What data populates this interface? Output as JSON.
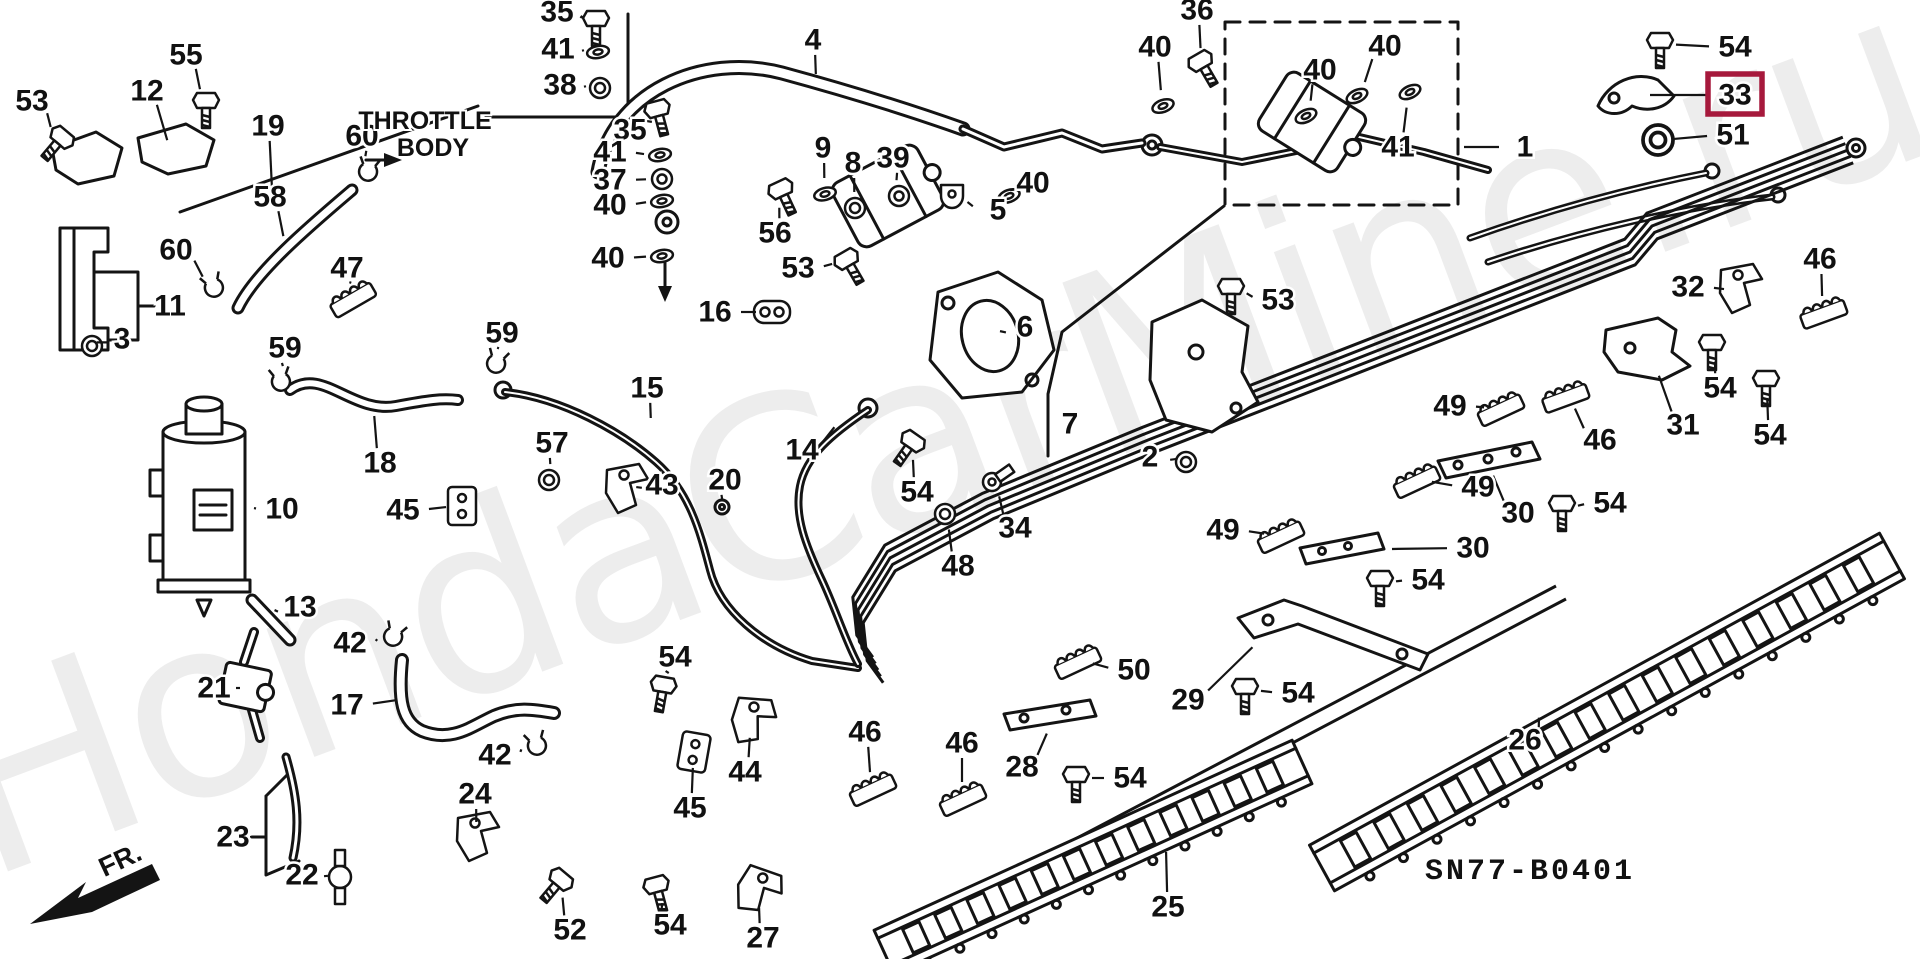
{
  "diagram": {
    "code": "SN77-B0401",
    "watermark": "HondaCarMine.ru",
    "throttle_label_line1": "THROTTLE",
    "throttle_label_line2": "BODY",
    "fr_label": "FR.",
    "ink_color": "#141414",
    "highlight": {
      "part": "33",
      "color": "#A6193C"
    },
    "labels": [
      {
        "n": "53",
        "x": 32,
        "y": 101,
        "px": 60,
        "py": 140,
        "i": "bolt",
        "r": 40
      },
      {
        "n": "12",
        "x": 147,
        "y": 91,
        "px": 168,
        "py": 142,
        "i": "none",
        "r": 0
      },
      {
        "n": "55",
        "x": 186,
        "y": 55,
        "px": 206,
        "py": 104,
        "i": "bolt",
        "r": 0
      },
      {
        "n": "19",
        "x": 268,
        "y": 126,
        "px": 272,
        "py": 188,
        "i": "none",
        "r": 0
      },
      {
        "n": "60",
        "x": 362,
        "y": 136,
        "px": 368,
        "py": 172,
        "i": "clip",
        "r": 10
      },
      {
        "n": "58",
        "x": 270,
        "y": 197,
        "px": 284,
        "py": 238,
        "i": "none",
        "r": 0
      },
      {
        "n": "60",
        "x": 176,
        "y": 250,
        "px": 214,
        "py": 288,
        "i": "clip",
        "r": -20
      },
      {
        "n": "47",
        "x": 347,
        "y": 268,
        "px": 352,
        "py": 298,
        "i": "comb",
        "r": -30
      },
      {
        "n": "11",
        "x": 170,
        "y": 306,
        "px": 154,
        "py": 306,
        "i": "none",
        "r": 0
      },
      {
        "n": "3",
        "x": 122,
        "y": 339,
        "px": 92,
        "py": 346,
        "i": "grommet",
        "r": 0
      },
      {
        "n": "35",
        "x": 557,
        "y": 12,
        "px": 596,
        "py": 22,
        "i": "bolt",
        "r": 0
      },
      {
        "n": "41",
        "x": 558,
        "y": 49,
        "px": 598,
        "py": 52,
        "i": "washer",
        "r": -10
      },
      {
        "n": "38",
        "x": 560,
        "y": 85,
        "px": 600,
        "py": 88,
        "i": "grommet",
        "r": 0
      },
      {
        "n": "35",
        "x": 630,
        "y": 130,
        "px": 658,
        "py": 112,
        "i": "bolt",
        "r": -15
      },
      {
        "n": "41",
        "x": 610,
        "y": 152,
        "px": 660,
        "py": 155,
        "i": "washer",
        "r": -10
      },
      {
        "n": "37",
        "x": 610,
        "y": 180,
        "px": 662,
        "py": 179,
        "i": "nut",
        "r": 0
      },
      {
        "n": "40",
        "x": 610,
        "y": 205,
        "px": 662,
        "py": 201,
        "i": "washer",
        "r": -10
      },
      {
        "n": "40",
        "x": 608,
        "y": 258,
        "px": 662,
        "py": 256,
        "i": "washer",
        "r": -10
      },
      {
        "n": "4",
        "x": 813,
        "y": 40,
        "px": 816,
        "py": 76,
        "i": "none",
        "r": 0
      },
      {
        "n": "9",
        "x": 823,
        "y": 148,
        "px": 825,
        "py": 194,
        "i": "washer",
        "r": -15
      },
      {
        "n": "8",
        "x": 853,
        "y": 163,
        "px": 855,
        "py": 208,
        "i": "grommet",
        "r": 0
      },
      {
        "n": "39",
        "x": 893,
        "y": 158,
        "px": 899,
        "py": 196,
        "i": "nut",
        "r": 0
      },
      {
        "n": "56",
        "x": 775,
        "y": 233,
        "px": 782,
        "py": 192,
        "i": "bolt",
        "r": -25
      },
      {
        "n": "53",
        "x": 798,
        "y": 268,
        "px": 848,
        "py": 262,
        "i": "bolt",
        "r": -30
      },
      {
        "n": "16",
        "x": 715,
        "y": 312,
        "px": 772,
        "py": 312,
        "i": "dgrommet",
        "r": 0
      },
      {
        "n": "5",
        "x": 998,
        "y": 210,
        "px": 952,
        "py": 198,
        "i": "clamp",
        "r": 0
      },
      {
        "n": "40",
        "x": 1033,
        "y": 183,
        "px": 1009,
        "py": 196,
        "i": "washer",
        "r": -20
      },
      {
        "n": "6",
        "x": 1025,
        "y": 327,
        "px": 1004,
        "py": 333,
        "i": "none",
        "r": 0
      },
      {
        "n": "7",
        "x": 1070,
        "y": 424,
        "px": 1052,
        "py": 424,
        "i": "none",
        "r": 0
      },
      {
        "n": "2",
        "x": 1150,
        "y": 457,
        "px": 1186,
        "py": 462,
        "i": "grommet",
        "r": 0
      },
      {
        "n": "36",
        "x": 1197,
        "y": 10,
        "px": 1202,
        "py": 64,
        "i": "bolt",
        "r": -30
      },
      {
        "n": "40",
        "x": 1155,
        "y": 47,
        "px": 1163,
        "py": 106,
        "i": "washer",
        "r": -20
      },
      {
        "n": "40",
        "x": 1320,
        "y": 70,
        "px": 1306,
        "py": 116,
        "i": "washer",
        "r": -25
      },
      {
        "n": "40",
        "x": 1385,
        "y": 46,
        "px": 1357,
        "py": 96,
        "i": "washer",
        "r": -25
      },
      {
        "n": "41",
        "x": 1398,
        "y": 147,
        "px": 1410,
        "py": 92,
        "i": "washer",
        "r": -25
      },
      {
        "n": "1",
        "x": 1525,
        "y": 147,
        "px": 1462,
        "py": 147,
        "i": "none",
        "r": 0
      },
      {
        "n": "54",
        "x": 1735,
        "y": 47,
        "px": 1660,
        "py": 44,
        "i": "bolt",
        "r": 0
      },
      {
        "n": "33",
        "x": 1735,
        "y": 95,
        "px": 1648,
        "py": 95,
        "i": "none",
        "r": 0
      },
      {
        "n": "51",
        "x": 1733,
        "y": 135,
        "px": 1658,
        "py": 140,
        "i": "grommet",
        "r": 0,
        "s": 1.5
      },
      {
        "n": "46",
        "x": 1820,
        "y": 259,
        "px": 1823,
        "py": 312,
        "i": "comb",
        "r": -20
      },
      {
        "n": "32",
        "x": 1688,
        "y": 287,
        "px": 1740,
        "py": 290,
        "i": "bracket",
        "r": 0
      },
      {
        "n": "54",
        "x": 1720,
        "y": 388,
        "px": 1712,
        "py": 346,
        "i": "bolt",
        "r": 0
      },
      {
        "n": "31",
        "x": 1683,
        "y": 425,
        "px": 1658,
        "py": 374,
        "i": "none",
        "r": 0
      },
      {
        "n": "54",
        "x": 1770,
        "y": 435,
        "px": 1766,
        "py": 382,
        "i": "bolt",
        "r": 0
      },
      {
        "n": "46",
        "x": 1600,
        "y": 440,
        "px": 1565,
        "py": 396,
        "i": "comb",
        "r": -20
      },
      {
        "n": "49",
        "x": 1450,
        "y": 406,
        "px": 1500,
        "py": 408,
        "i": "comb",
        "r": -25
      },
      {
        "n": "49",
        "x": 1478,
        "y": 487,
        "px": 1416,
        "py": 480,
        "i": "comb",
        "r": -25
      },
      {
        "n": "30",
        "x": 1518,
        "y": 513,
        "px": 1492,
        "py": 474,
        "i": "none",
        "r": 0
      },
      {
        "n": "54",
        "x": 1610,
        "y": 503,
        "px": 1562,
        "py": 507,
        "i": "bolt",
        "r": 0
      },
      {
        "n": "30",
        "x": 1473,
        "y": 548,
        "px": 1390,
        "py": 549,
        "i": "none",
        "r": 0
      },
      {
        "n": "53",
        "x": 1278,
        "y": 300,
        "px": 1231,
        "py": 290,
        "i": "bolt",
        "r": 0
      },
      {
        "n": "49",
        "x": 1223,
        "y": 530,
        "px": 1280,
        "py": 535,
        "i": "comb",
        "r": -25
      },
      {
        "n": "54",
        "x": 1428,
        "y": 580,
        "px": 1380,
        "py": 582,
        "i": "bolt",
        "r": 0
      },
      {
        "n": "50",
        "x": 1134,
        "y": 670,
        "px": 1077,
        "py": 661,
        "i": "comb",
        "r": -25
      },
      {
        "n": "29",
        "x": 1188,
        "y": 700,
        "px": 1254,
        "py": 646,
        "i": "none",
        "r": 0
      },
      {
        "n": "54",
        "x": 1298,
        "y": 693,
        "px": 1245,
        "py": 690,
        "i": "bolt",
        "r": 0
      },
      {
        "n": "26",
        "x": 1525,
        "y": 740,
        "px": 1540,
        "py": 716,
        "i": "none",
        "r": 0
      },
      {
        "n": "25",
        "x": 1168,
        "y": 907,
        "px": 1166,
        "py": 850,
        "i": "none",
        "r": 0
      },
      {
        "n": "54",
        "x": 1130,
        "y": 778,
        "px": 1076,
        "py": 778,
        "i": "bolt",
        "r": 0
      },
      {
        "n": "28",
        "x": 1022,
        "y": 767,
        "px": 1048,
        "py": 732,
        "i": "none",
        "r": 0
      },
      {
        "n": "46",
        "x": 865,
        "y": 732,
        "px": 872,
        "py": 788,
        "i": "comb",
        "r": -25
      },
      {
        "n": "46",
        "x": 962,
        "y": 743,
        "px": 962,
        "py": 798,
        "i": "comb",
        "r": -25
      },
      {
        "n": "44",
        "x": 745,
        "y": 772,
        "px": 752,
        "py": 722,
        "i": "bracket",
        "r": 15
      },
      {
        "n": "45",
        "x": 690,
        "y": 808,
        "px": 694,
        "py": 752,
        "i": "block",
        "r": 10
      },
      {
        "n": "54",
        "x": 675,
        "y": 657,
        "px": 663,
        "py": 688,
        "i": "bolt",
        "r": 10
      },
      {
        "n": "48",
        "x": 958,
        "y": 566,
        "px": 945,
        "py": 514,
        "i": "grommet",
        "r": 0
      },
      {
        "n": "34",
        "x": 1015,
        "y": 528,
        "px": 992,
        "py": 482,
        "i": "ring",
        "r": -35
      },
      {
        "n": "54",
        "x": 917,
        "y": 492,
        "px": 911,
        "py": 444,
        "i": "bolt",
        "r": 35
      },
      {
        "n": "14",
        "x": 802,
        "y": 450,
        "px": 836,
        "py": 426,
        "i": "none",
        "r": 0
      },
      {
        "n": "20",
        "x": 725,
        "y": 480,
        "px": 722,
        "py": 502,
        "i": "none",
        "r": 0
      },
      {
        "n": "43",
        "x": 662,
        "y": 485,
        "px": 626,
        "py": 490,
        "i": "bracket",
        "r": 0
      },
      {
        "n": "15",
        "x": 647,
        "y": 388,
        "px": 651,
        "py": 420,
        "i": "none",
        "r": 0
      },
      {
        "n": "57",
        "x": 552,
        "y": 443,
        "px": 549,
        "py": 480,
        "i": "grommet",
        "r": 0
      },
      {
        "n": "59",
        "x": 502,
        "y": 333,
        "px": 496,
        "py": 364,
        "i": "clip",
        "r": 15
      },
      {
        "n": "59",
        "x": 285,
        "y": 348,
        "px": 281,
        "py": 382,
        "i": "clip",
        "r": -10
      },
      {
        "n": "18",
        "x": 380,
        "y": 463,
        "px": 374,
        "py": 414,
        "i": "none",
        "r": 0
      },
      {
        "n": "10",
        "x": 282,
        "y": 509,
        "px": 252,
        "py": 508,
        "i": "none",
        "r": 0
      },
      {
        "n": "45",
        "x": 403,
        "y": 510,
        "px": 462,
        "py": 506,
        "i": "block",
        "r": 0
      },
      {
        "n": "13",
        "x": 300,
        "y": 607,
        "px": 276,
        "py": 612,
        "i": "none",
        "r": 0
      },
      {
        "n": "42",
        "x": 350,
        "y": 643,
        "px": 393,
        "py": 637,
        "i": "clip",
        "r": 20
      },
      {
        "n": "21",
        "x": 214,
        "y": 688,
        "px": 238,
        "py": 688,
        "i": "none",
        "r": 0
      },
      {
        "n": "17",
        "x": 347,
        "y": 705,
        "px": 398,
        "py": 700,
        "i": "none",
        "r": 0
      },
      {
        "n": "42",
        "x": 495,
        "y": 755,
        "px": 537,
        "py": 746,
        "i": "clip",
        "r": -15
      },
      {
        "n": "24",
        "x": 475,
        "y": 794,
        "px": 477,
        "py": 838,
        "i": "bracket",
        "r": 0
      },
      {
        "n": "23",
        "x": 233,
        "y": 837,
        "px": 252,
        "py": 837,
        "i": "none",
        "r": 0
      },
      {
        "n": "22",
        "x": 302,
        "y": 875,
        "px": 340,
        "py": 877,
        "i": "valve",
        "r": 0
      },
      {
        "n": "52",
        "x": 570,
        "y": 930,
        "px": 559,
        "py": 882,
        "i": "bolt",
        "r": 40
      },
      {
        "n": "27",
        "x": 763,
        "y": 938,
        "px": 757,
        "py": 892,
        "i": "bracket",
        "r": 30
      },
      {
        "n": "54",
        "x": 670,
        "y": 925,
        "px": 657,
        "py": 888,
        "i": "bolt",
        "r": -15
      }
    ]
  }
}
